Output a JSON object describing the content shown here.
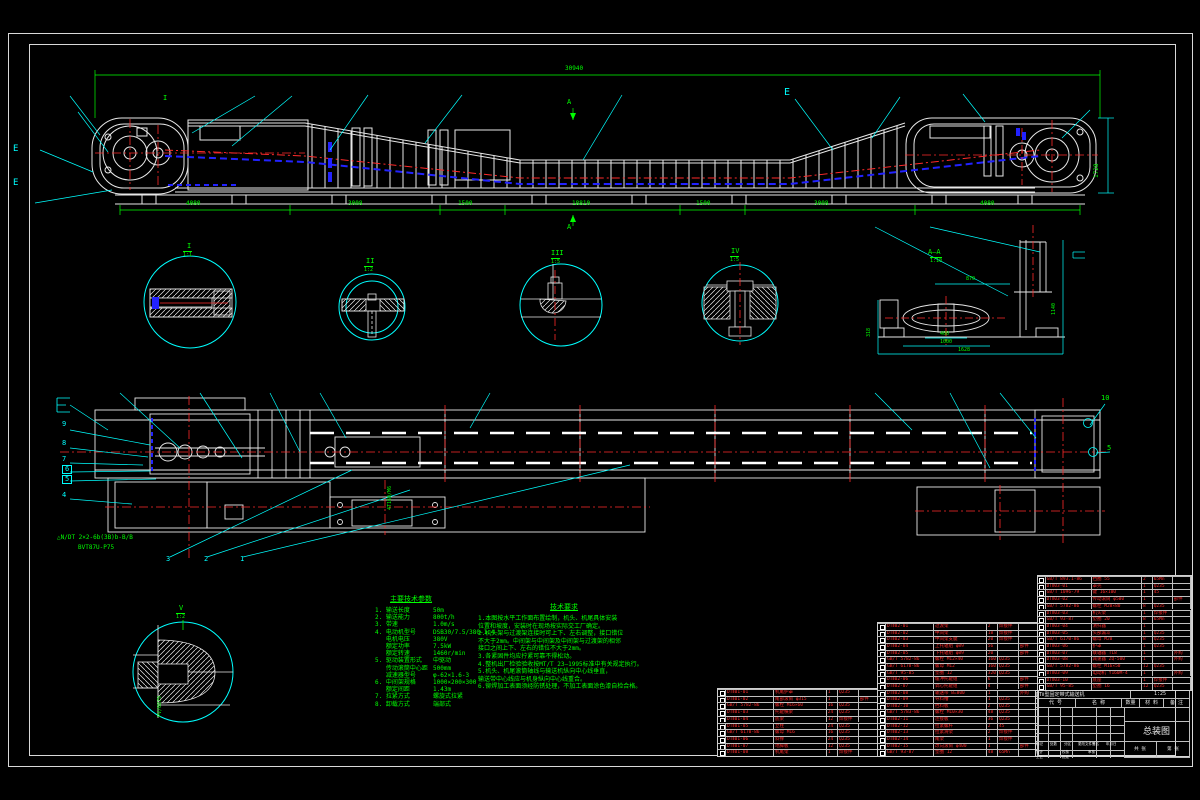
{
  "colors": {
    "bg": "#000000",
    "line": "#e8e8e8",
    "green": "#00ff00",
    "cyan": "#00ffff",
    "red": "#ff2a2a",
    "blue": "#2222ff"
  },
  "top_view": {
    "overall": "30940",
    "dims": [
      "4080",
      "3008",
      "1500",
      "18810",
      "1500",
      "3008",
      "4080"
    ],
    "height_right": "1728",
    "marker_i": "I",
    "marker_a": "A",
    "marker_e": "E"
  },
  "details": [
    {
      "label": "I",
      "scale": "1:1"
    },
    {
      "label": "II",
      "scale": "1:2"
    },
    {
      "label": "III",
      "scale": "1:5"
    },
    {
      "label": "IV",
      "scale": "1:5"
    }
  ],
  "section_aa": {
    "label": "A—A",
    "scale": "1:10",
    "dim_top": "870",
    "dim_left": "318",
    "dim_b1": "400",
    "dim_b2": "1000",
    "dim_b3": "1628",
    "dim_right": "1140"
  },
  "detail_v": {
    "label": "V",
    "scale": "1:2",
    "side_text": "PV/0879"
  },
  "plan": {
    "balloons_left": [
      "9",
      "8",
      "7",
      "6",
      "5",
      "4"
    ],
    "balloons_bottom": [
      "3",
      "2",
      "1"
    ],
    "balloon_r1": "10",
    "balloon_r2": "5",
    "label1": "△N/DT 2×2-6b(3B)b-B/B",
    "label2": "BVT87U-P75",
    "motor_label": "4T160/M6",
    "marker_e": "E"
  },
  "tech_params": {
    "title": "主要技术参数",
    "rows": [
      {
        "k": "1. 输送长度",
        "v": "50m"
      },
      {
        "k": "2. 输送能力",
        "v": "800t/h"
      },
      {
        "k": "3. 带速",
        "v": "1.0m/s"
      },
      {
        "k": "4. 电动机型号",
        "v": "DSB30/7.5/380-1.4"
      },
      {
        "k": "   电机电压",
        "v": "380V"
      },
      {
        "k": "   额定功率",
        "v": "7.5kW"
      },
      {
        "k": "   额定转速",
        "v": "1460r/min"
      },
      {
        "k": "5. 驱动装置形式",
        "v": "中驱动"
      },
      {
        "k": "   传动滚筒中心距",
        "v": "500mm"
      },
      {
        "k": "   减速器型号",
        "v": "φ-62×1.6-3"
      },
      {
        "k": "6. 中间架规格",
        "v": "1000×200×300"
      },
      {
        "k": "   额定间距",
        "v": "1.43m"
      },
      {
        "k": "7. 拉紧方式",
        "v": "螺旋式拉紧"
      },
      {
        "k": "8. 卸载方式",
        "v": "端部式"
      }
    ]
  },
  "tech_req": {
    "title": "技术要求",
    "lines": [
      "1.本图按水平工作面布置绘制，机头、机尾具体安装",
      "位置和坡度，安装时在现场按实际交工厂确定。",
      "2.机头架与过渡架连接时可上下、左右调整，接口错位",
      "不大于2mm。中间架与中间架及中间架与过渡架的相邻",
      "接口之间上下、左右的错位不大于2mm。",
      "3.各紧固件均应拧紧可靠不得松动。",
      "4.整机出厂检验验收按MT/T 23—1995标准中有关规定执行。",
      "5.机头、机尾滚筒轴线与输送机纵向中心线垂直，",
      "输送带中心线应与机身纵向中心线重合。",
      "6.铆焊加工表面须经防锈处理，不加工表面涂色漆自检合格。"
    ]
  },
  "bom": {
    "table_a": [
      [
        "10",
        "DTⅡ01-01",
        "机尾护罩",
        "1",
        "Q235",
        ""
      ],
      [
        "9",
        "DTⅡ01-02",
        "尾部滚筒 φ315",
        "1",
        "",
        "部件"
      ],
      [
        "8",
        "GB/T 5782-86",
        "螺栓 M16×60",
        "16",
        "Q235",
        ""
      ],
      [
        "7",
        "DTⅡ01-03",
        "托辊横梁",
        "24",
        "Q235",
        ""
      ],
      [
        "6",
        "DTⅡ01-04",
        "底梁",
        "12",
        "焊接件",
        ""
      ],
      [
        "5",
        "DTⅡ01-05",
        "立柱",
        "24",
        "Q235",
        ""
      ],
      [
        "4",
        "GB/T 6170-86",
        "螺母 M16",
        "16",
        "Q235",
        ""
      ],
      [
        "3",
        "DTⅡ01-06",
        "斜撑",
        "24",
        "Q235",
        ""
      ],
      [
        "2",
        "DTⅡ01-07",
        "地脚板",
        "12",
        "Q235",
        ""
      ],
      [
        "1",
        "DTⅡ01-08",
        "机尾架",
        "1",
        "焊接件",
        ""
      ]
    ],
    "table_b": [
      [
        "34",
        "DTⅡ02-01",
        "过渡架",
        "2",
        "焊接件",
        ""
      ],
      [
        "33",
        "DTⅡ02-02",
        "中间架",
        "18",
        "焊接件",
        ""
      ],
      [
        "32",
        "DTⅡ02-03",
        "中间架支腿",
        "20",
        "焊接件",
        ""
      ],
      [
        "31",
        "DTⅡ02-04",
        "上托辊组 φ89",
        "56",
        "",
        "部件"
      ],
      [
        "30",
        "DTⅡ02-05",
        "下托辊组 φ89",
        "20",
        "",
        "部件"
      ],
      [
        "29",
        "GB/T 5782-86",
        "螺栓 M12×40",
        "160",
        "Q235",
        ""
      ],
      [
        "28",
        "GB/T 6170-86",
        "螺母 M12",
        "160",
        "Q235",
        ""
      ],
      [
        "27",
        "GB/T 95-85",
        "垫圈 12",
        "320",
        "Q235",
        ""
      ],
      [
        "26",
        "DTⅡ02-06",
        "缓冲托辊组",
        "6",
        "",
        "部件"
      ],
      [
        "25",
        "DTⅡ02-07",
        "调心托辊组",
        "4",
        "",
        "部件"
      ],
      [
        "24",
        "DTⅡ02-08",
        "输送带 B=800",
        "1",
        "",
        "外购"
      ],
      [
        "23",
        "DTⅡ02-09",
        "导料槽",
        "1",
        "Q235",
        ""
      ],
      [
        "22",
        "DTⅡ02-10",
        "挡料板",
        "2",
        "Q235",
        ""
      ],
      [
        "21",
        "GB/T 5783-86",
        "螺栓 M10×30",
        "48",
        "Q235",
        ""
      ],
      [
        "20",
        "DTⅡ02-11",
        "连接板",
        "36",
        "Q235",
        ""
      ],
      [
        "19",
        "DTⅡ02-12",
        "拉紧螺杆",
        "2",
        "45",
        ""
      ],
      [
        "18",
        "DTⅡ02-13",
        "拉紧滑架",
        "2",
        "焊接件",
        ""
      ],
      [
        "17",
        "DTⅡ02-14",
        "尾架",
        "1",
        "焊接件",
        ""
      ],
      [
        "16",
        "DTⅡ02-15",
        "改向滚筒 φ400",
        "1",
        "",
        "部件"
      ],
      [
        "15",
        "GB/T 93-87",
        "垫圈 12",
        "48",
        "65Mn",
        ""
      ]
    ],
    "table_c": [
      [
        "51",
        "GB/T 893.1-86",
        "挡圈 55",
        "2",
        "65Mn",
        ""
      ],
      [
        "50",
        "DTⅡ03-01",
        "罩壳",
        "1",
        "Q235",
        ""
      ],
      [
        "49",
        "GB/T 1096-79",
        "键 16×100",
        "1",
        "45",
        ""
      ],
      [
        "48",
        "DTⅡ03-02",
        "传动滚筒 φ500",
        "1",
        "",
        "部件"
      ],
      [
        "47",
        "GB/T 5782-86",
        "螺栓 M20×80",
        "8",
        "Q235",
        ""
      ],
      [
        "46",
        "DTⅡ03-03",
        "机头架",
        "1",
        "焊接件",
        ""
      ],
      [
        "45",
        "GB/T 93-87",
        "垫圈 20",
        "8",
        "65Mn",
        ""
      ],
      [
        "44",
        "DTⅡ03-04",
        "清扫器",
        "1",
        "",
        ""
      ],
      [
        "43",
        "DTⅡ03-05",
        "头部漏斗",
        "1",
        "Q235",
        ""
      ],
      [
        "42",
        "GB/T 6170-86",
        "螺母 M20",
        "8",
        "Q235",
        ""
      ],
      [
        "41",
        "DTⅡ03-06",
        "护罩",
        "1",
        "Q235",
        ""
      ],
      [
        "40",
        "DTⅡ03-07",
        "联轴器 TL8",
        "1",
        "",
        "外购"
      ],
      [
        "39",
        "DTⅡ03-08",
        "减速器 ZQ-500",
        "1",
        "",
        "外购"
      ],
      [
        "38",
        "GB/T 5782-86",
        "螺栓 M16×50",
        "12",
        "Q235",
        ""
      ],
      [
        "37",
        "DTⅡ03-09",
        "电动机 Y160M-4",
        "1",
        "",
        "外购"
      ],
      [
        "36",
        "DTⅡ03-10",
        "底座",
        "1",
        "焊接件",
        ""
      ],
      [
        "35",
        "GB/T 95-85",
        "垫圈 16",
        "12",
        "Q235",
        ""
      ]
    ]
  },
  "title_block": {
    "code": "DTⅡ型固定带式输送机",
    "scale": "1:25",
    "headers": [
      "代  号",
      "名  称",
      "数量",
      "材 料",
      "备 注"
    ],
    "title": "总装图",
    "rev": [
      "标记",
      "处数",
      "分区",
      "更改文件号",
      "签名",
      "年月日"
    ],
    "signs": [
      "设计",
      "校核",
      "审核",
      "工艺",
      "批准"
    ],
    "sheet1": "共 张",
    "sheet2": "第 张"
  }
}
